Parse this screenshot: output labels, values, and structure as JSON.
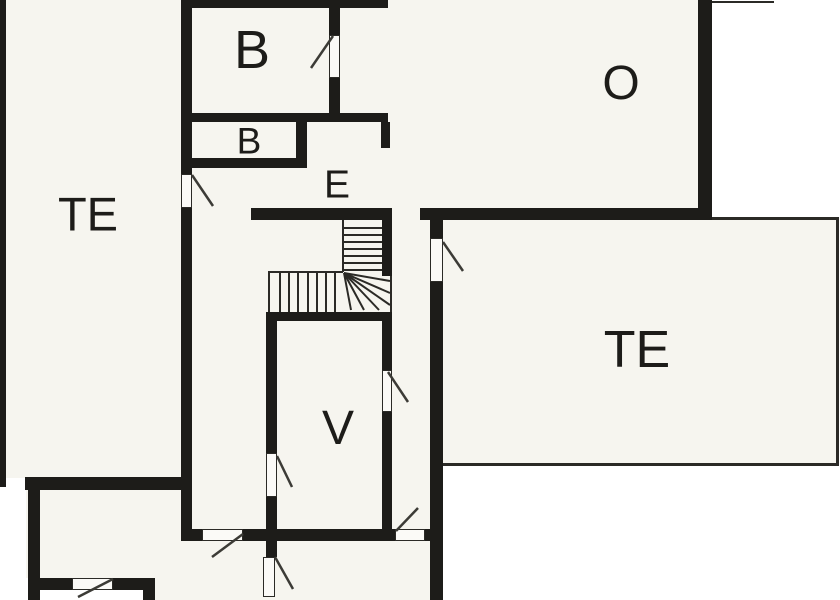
{
  "page": {
    "title": "Floor plan",
    "background": "#ffffff"
  },
  "palette": {
    "wall": "#1d1c19",
    "interior": "#f6f5ef",
    "line": "#2b2a26",
    "door_leaf": "#3c3b36",
    "outside": "#ffffff",
    "label": "#1d1c19"
  },
  "rooms": [
    {
      "id": "b-upper",
      "label": "B",
      "x": 252,
      "y": 50,
      "size": 54
    },
    {
      "id": "b-lower",
      "label": "B",
      "x": 249,
      "y": 141,
      "size": 37
    },
    {
      "id": "e",
      "label": "E",
      "x": 337,
      "y": 185,
      "size": 39
    },
    {
      "id": "o",
      "label": "O",
      "x": 621,
      "y": 84,
      "size": 48
    },
    {
      "id": "te-left",
      "label": "TE",
      "x": 88,
      "y": 214,
      "size": 47
    },
    {
      "id": "te-right",
      "label": "TE",
      "x": 637,
      "y": 350,
      "size": 52
    },
    {
      "id": "v",
      "label": "V",
      "x": 338,
      "y": 429,
      "size": 48
    }
  ],
  "floorplan": {
    "width": 840,
    "height": 600,
    "interior": [
      [
        6,
        0,
        706,
        219
      ],
      [
        6,
        219,
        424,
        259
      ],
      [
        26,
        478,
        404,
        100
      ],
      [
        155,
        578,
        275,
        22
      ],
      [
        443,
        219,
        393,
        245
      ]
    ],
    "walls": [
      [
        0,
        0,
        6,
        487
      ],
      [
        25,
        477,
        167,
        13
      ],
      [
        28,
        477,
        12,
        123
      ],
      [
        28,
        578,
        44,
        12
      ],
      [
        113,
        578,
        42,
        12
      ],
      [
        143,
        578,
        12,
        22
      ],
      [
        183,
        0,
        205,
        8
      ],
      [
        181,
        0,
        11,
        174
      ],
      [
        181,
        208,
        11,
        322
      ],
      [
        181,
        529,
        21,
        12
      ],
      [
        183,
        113,
        205,
        9
      ],
      [
        329,
        0,
        11,
        35
      ],
      [
        329,
        78,
        11,
        36
      ],
      [
        296,
        122,
        11,
        44
      ],
      [
        183,
        158,
        124,
        10
      ],
      [
        381,
        122,
        9,
        26
      ],
      [
        251,
        208,
        141,
        12
      ],
      [
        420,
        208,
        292,
        12
      ],
      [
        698,
        0,
        14,
        219
      ],
      [
        382,
        208,
        10,
        68
      ],
      [
        266,
        312,
        126,
        9
      ],
      [
        266,
        312,
        11,
        141
      ],
      [
        266,
        497,
        11,
        60
      ],
      [
        382,
        312,
        10,
        58
      ],
      [
        382,
        412,
        10,
        129
      ],
      [
        243,
        529,
        152,
        12
      ],
      [
        425,
        529,
        18,
        12
      ],
      [
        430,
        219,
        13,
        19
      ],
      [
        430,
        282,
        13,
        318
      ]
    ],
    "thin_lines": [
      [
        710,
        1,
        64,
        2
      ],
      [
        712,
        217,
        126,
        3
      ],
      [
        836,
        217,
        3,
        249
      ],
      [
        443,
        463,
        396,
        3
      ],
      [
        342,
        220,
        2,
        52
      ],
      [
        268,
        271,
        75,
        2
      ],
      [
        268,
        271,
        2,
        41
      ],
      [
        390,
        276,
        2,
        36
      ]
    ],
    "door_openings": [
      [
        181,
        174,
        11,
        34
      ],
      [
        329,
        35,
        11,
        43
      ],
      [
        430,
        238,
        13,
        44
      ],
      [
        266,
        453,
        11,
        44
      ],
      [
        382,
        370,
        10,
        42
      ],
      [
        202,
        529,
        41,
        12
      ],
      [
        395,
        529,
        30,
        12
      ],
      [
        72,
        578,
        41,
        12
      ],
      [
        263,
        557,
        12,
        40
      ]
    ],
    "door_swings": [
      [
        192,
        175,
        213,
        206
      ],
      [
        333,
        36,
        311,
        68
      ],
      [
        443,
        242,
        463,
        271
      ],
      [
        277,
        456,
        292,
        487
      ],
      [
        388,
        372,
        408,
        402
      ],
      [
        243,
        534,
        212,
        557
      ],
      [
        275,
        557,
        293,
        589
      ],
      [
        396,
        531,
        418,
        508
      ],
      [
        113,
        579,
        78,
        597
      ]
    ],
    "stairs": {
      "flights": [
        {
          "dir": "vertical",
          "x": 343,
          "y": 220,
          "w": 39,
          "h": 56,
          "treads": 7
        },
        {
          "dir": "horizontal",
          "x": 270,
          "y": 273,
          "w": 73,
          "h": 39,
          "treads": 7
        }
      ],
      "winder": {
        "cx": 344,
        "cy": 273,
        "ends": [
          [
            390,
            281
          ],
          [
            390,
            293
          ],
          [
            390,
            305
          ],
          [
            379,
            310
          ],
          [
            364,
            310
          ],
          [
            351,
            310
          ]
        ]
      }
    }
  }
}
